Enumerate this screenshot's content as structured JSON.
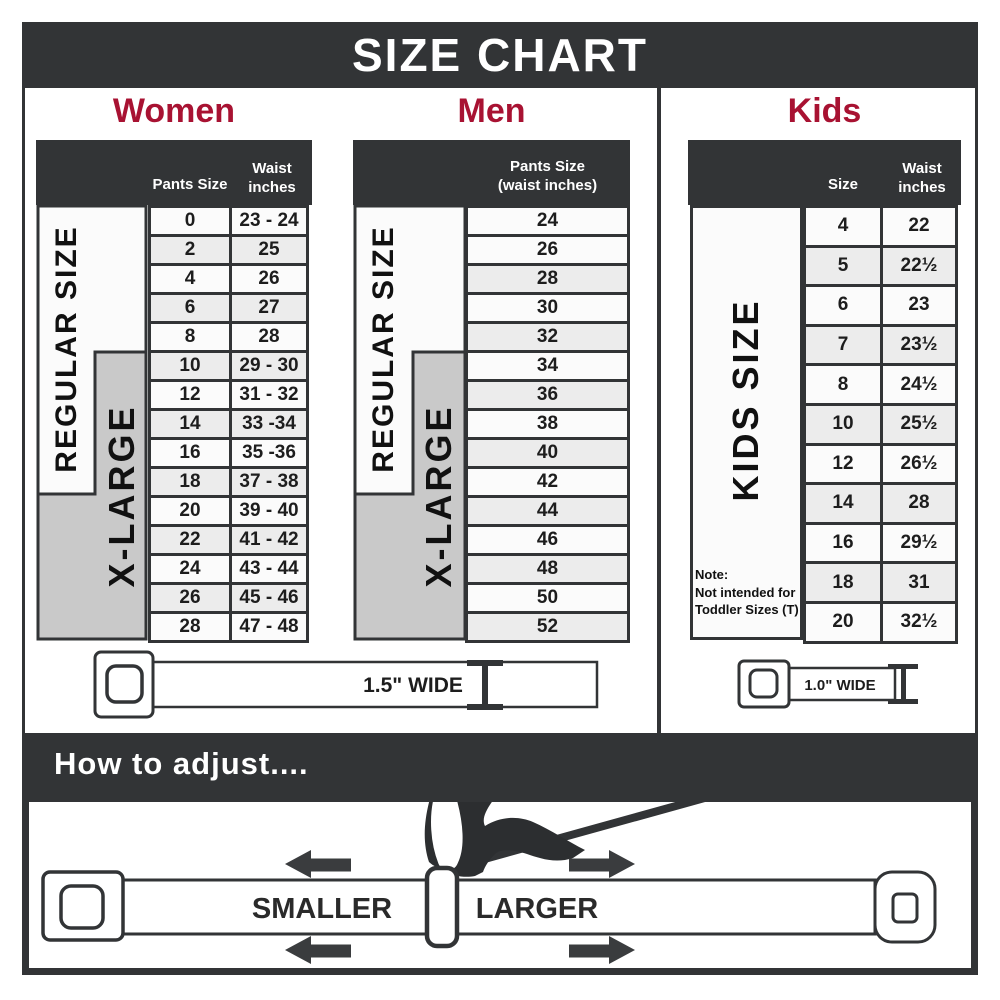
{
  "banner": {
    "title": "SIZE CHART"
  },
  "women": {
    "title": "Women",
    "col_pants": "Pants Size",
    "col_waist_l1": "Waist",
    "col_waist_l2": "inches",
    "regular_label": "REGULAR SIZE",
    "xlarge_label": "X-LARGE",
    "belt_label": "1.5\" WIDE"
  },
  "men": {
    "title": "Men",
    "col_l1": "Pants Size",
    "col_l2": "(waist inches)",
    "regular_label": "REGULAR SIZE",
    "xlarge_label": "X-LARGE"
  },
  "kids": {
    "title": "Kids",
    "col_size": "Size",
    "col_waist_l1": "Waist",
    "col_waist_l2": "inches",
    "band_label": "KIDS SIZE",
    "note_l1": "Note:",
    "note_l2": "Not intended for",
    "note_l3": "Toddler Sizes (T)",
    "belt_label": "1.0\" WIDE"
  },
  "adjust": {
    "title": "How to adjust....",
    "smaller": "SMALLER",
    "larger": "LARGER"
  },
  "colors": {
    "dark": "#323436",
    "accent_red": "#a81232",
    "band_gray": "#c9c9c9",
    "row_alt": "#ececec"
  },
  "chart_data": [
    {
      "type": "table",
      "title": "Women",
      "columns": [
        "Pants Size",
        "Waist inches"
      ],
      "size_bands": {
        "regular": "REGULAR SIZE",
        "xlarge": "X-LARGE"
      },
      "belt_width": "1.5\" WIDE",
      "rows": [
        [
          "0",
          "23 - 24"
        ],
        [
          "2",
          "25"
        ],
        [
          "4",
          "26"
        ],
        [
          "6",
          "27"
        ],
        [
          "8",
          "28"
        ],
        [
          "10",
          "29 - 30"
        ],
        [
          "12",
          "31 - 32"
        ],
        [
          "14",
          "33 -34"
        ],
        [
          "16",
          "35 -36"
        ],
        [
          "18",
          "37 - 38"
        ],
        [
          "20",
          "39 - 40"
        ],
        [
          "22",
          "41 - 42"
        ],
        [
          "24",
          "43 - 44"
        ],
        [
          "26",
          "45 - 46"
        ],
        [
          "28",
          "47 - 48"
        ]
      ]
    },
    {
      "type": "table",
      "title": "Men",
      "columns": [
        "Pants Size (waist inches)"
      ],
      "size_bands": {
        "regular": "REGULAR SIZE",
        "xlarge": "X-LARGE"
      },
      "belt_width": "1.5\" WIDE",
      "rows": [
        [
          "24"
        ],
        [
          "26"
        ],
        [
          "28"
        ],
        [
          "30"
        ],
        [
          "32"
        ],
        [
          "34"
        ],
        [
          "36"
        ],
        [
          "38"
        ],
        [
          "40"
        ],
        [
          "42"
        ],
        [
          "44"
        ],
        [
          "46"
        ],
        [
          "48"
        ],
        [
          "50"
        ],
        [
          "52"
        ]
      ]
    },
    {
      "type": "table",
      "title": "Kids",
      "columns": [
        "Size",
        "Waist inches"
      ],
      "size_bands": {
        "kids": "KIDS SIZE"
      },
      "note": "Note: Not intended for Toddler Sizes (T)",
      "belt_width": "1.0\" WIDE",
      "rows": [
        [
          "4",
          "22"
        ],
        [
          "5",
          "22½"
        ],
        [
          "6",
          "23"
        ],
        [
          "7",
          "23½"
        ],
        [
          "8",
          "24½"
        ],
        [
          "10",
          "25½"
        ],
        [
          "12",
          "26½"
        ],
        [
          "14",
          "28"
        ],
        [
          "16",
          "29½"
        ],
        [
          "18",
          "31"
        ],
        [
          "20",
          "32½"
        ]
      ]
    }
  ]
}
